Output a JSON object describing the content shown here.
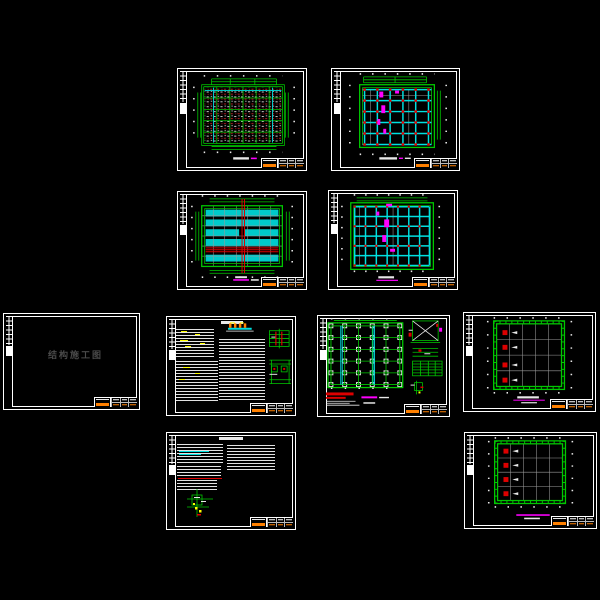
{
  "app": {
    "type": "cad-structural-drawing-set-preview",
    "background": "#000000",
    "sheet_count": 10
  },
  "palette": {
    "frame_white": "#ffffff",
    "grid_green": "#00c800",
    "beam_cyan": "#00e0e0",
    "column_red": "#dd0000",
    "annotation_magenta": "#ff00ff",
    "highlight_yellow": "#ffff00",
    "titleblock_orange": "#ff8000",
    "gridline_gray": "#9a9a9a",
    "cover_text_gray": "#4a4a4a"
  },
  "cover": {
    "title": "结构施工图"
  },
  "sheets": [
    {
      "id": "beam-reinforcement-plan-1"
    },
    {
      "id": "beam-reinforcement-plan-2"
    },
    {
      "id": "slab-plan-1"
    },
    {
      "id": "slab-plan-2"
    },
    {
      "id": "cover-sheet"
    },
    {
      "id": "general-notes-1"
    },
    {
      "id": "foundation-plan"
    },
    {
      "id": "ring-beam-plan-1"
    },
    {
      "id": "general-notes-2"
    },
    {
      "id": "ring-beam-plan-2"
    }
  ]
}
